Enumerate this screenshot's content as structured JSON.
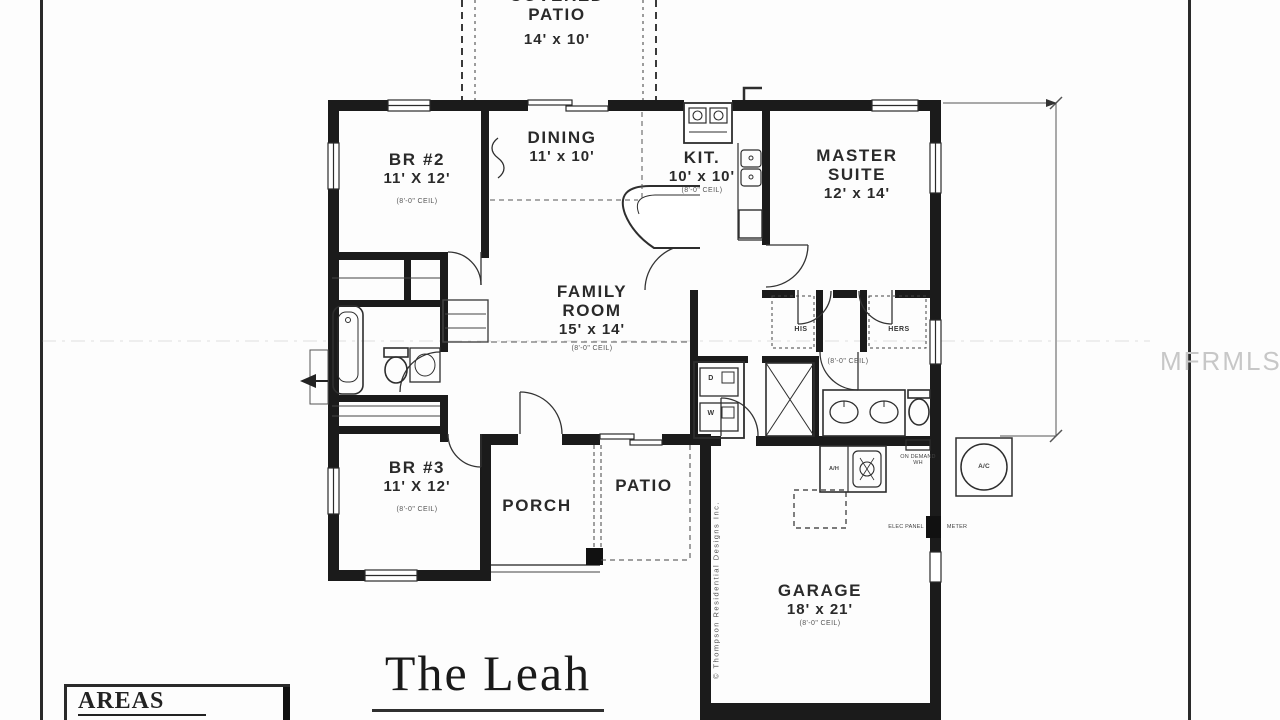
{
  "page": {
    "plan_title": "The Leah",
    "areas_heading": "AREAS",
    "watermark": "MFRMLS",
    "copyright_vertical": "© Thompson Residential Designs Inc."
  },
  "rooms": {
    "covered_patio": {
      "name_line1": "COVERED",
      "name_line2": "PATIO",
      "dims": "14' x 10'"
    },
    "br2": {
      "name": "BR #2",
      "dims": "11' X 12'",
      "ceil": "(8'-0\" CEIL)"
    },
    "dining": {
      "name": "DINING",
      "dims": "11' x 10'"
    },
    "kitchen": {
      "name": "KIT.",
      "dims": "10' x 10'",
      "ceil": "(8'-0\" CEIL)"
    },
    "master": {
      "name_line1": "MASTER",
      "name_line2": "SUITE",
      "dims": "12' x 14'"
    },
    "family": {
      "name_line1": "FAMILY",
      "name_line2": "ROOM",
      "dims": "15' x 14'",
      "ceil": "(8'-0\" CEIL)"
    },
    "br3": {
      "name": "BR #3",
      "dims": "11' X 12'",
      "ceil": "(8'-0\" CEIL)"
    },
    "porch": {
      "name": "PORCH"
    },
    "patio": {
      "name": "PATIO"
    },
    "garage": {
      "name": "GARAGE",
      "dims": "18' x 21'",
      "ceil": "(8'-0\" CEIL)"
    }
  },
  "labels": {
    "his": "HIS",
    "hers": "HERS",
    "dryer": "D",
    "washer": "W",
    "air_handler": "A/H",
    "ac_unit": "A/C",
    "water_heater_line1": "ON DEMAND",
    "water_heater_line2": "WH",
    "bath_ceil": "(8'-0\" CEIL)",
    "elec_panel": "ELEC PANEL",
    "elec_meter": "METER"
  },
  "colors": {
    "wall": "#1b1b1b",
    "paper": "#fdfdfd",
    "watermark": "#c7c7c7"
  }
}
